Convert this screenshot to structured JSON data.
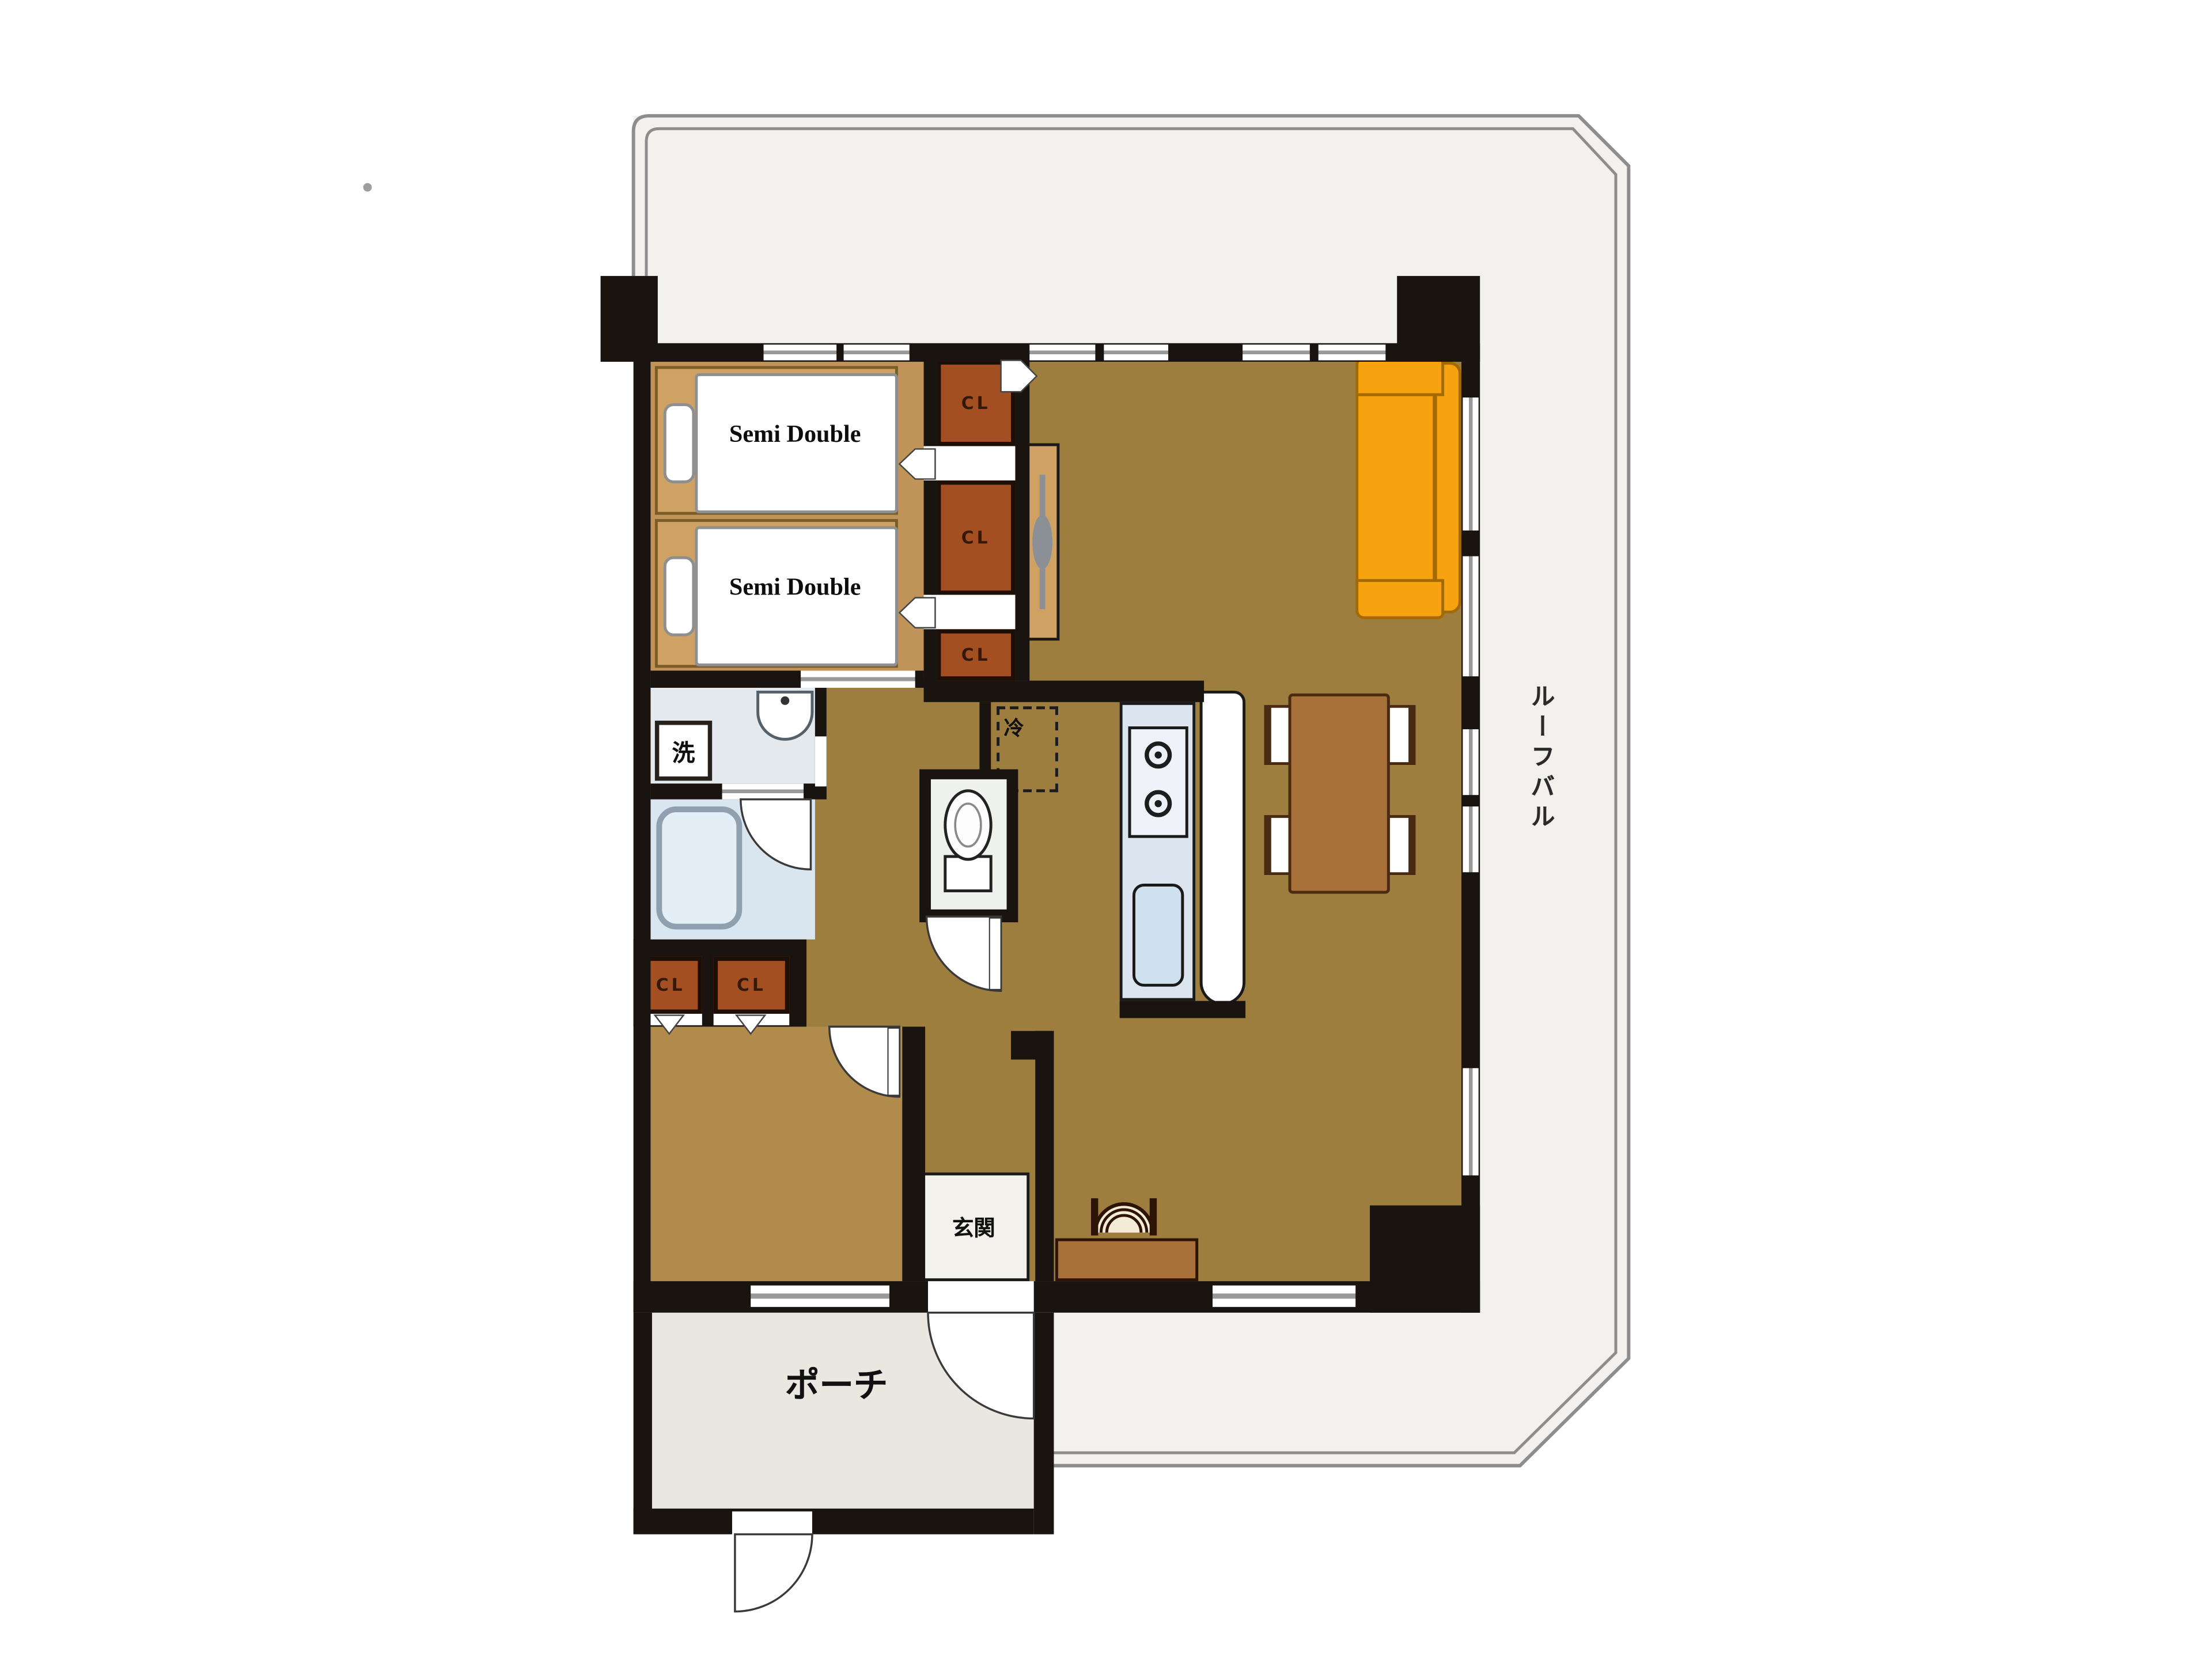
{
  "labels": {
    "bed": "Semi Double",
    "closet": "CL",
    "washer": "洗",
    "fridge": "冷",
    "entrance": "玄関",
    "porch": "ポーチ",
    "roof_balcony": "ルーフバル"
  },
  "colors": {
    "wall": "#1a1410",
    "balcony": "#f2f1ee",
    "balcony_line": "#8d8d8d",
    "ldk": "#9d7e3f",
    "bedroom": "#c09459",
    "room2": "#b18b4b",
    "bed_frame": "#cfa263",
    "bed_frame_line": "#7a5c28",
    "closet": "#a34f22",
    "washroom": "#e3e9ed",
    "bathroom": "#d9e6f0",
    "toilet_floor": "#eef1ec",
    "kitchen": "#dce5ef",
    "sofa": "#f7a30f",
    "sofa_line": "#a36a00",
    "wood": "#a8713a",
    "wood_line": "#4a2a10",
    "porch": "#eae7e1",
    "genkan": "#f3f1ec",
    "window_line": "#999999",
    "text": "#111111"
  }
}
